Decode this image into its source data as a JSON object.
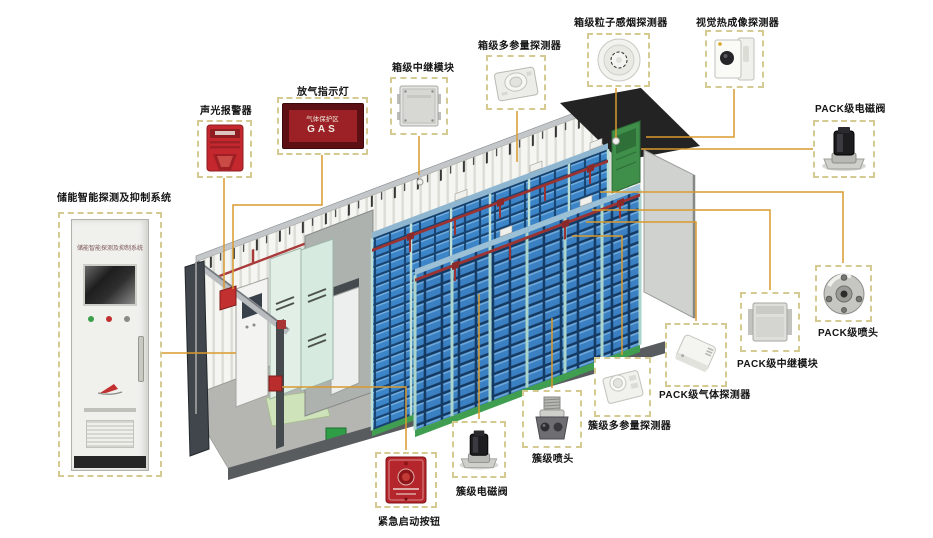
{
  "diagram": {
    "callouts": [
      {
        "id": "system-cabinet",
        "label": "储能智能探测及抑制系统"
      },
      {
        "id": "sound-light-alarm",
        "label": "声光报警器"
      },
      {
        "id": "gas-release-indicator",
        "label": "放气指示灯"
      },
      {
        "id": "box-relay-module",
        "label": "箱级中继模块"
      },
      {
        "id": "box-multi-param-detector",
        "label": "箱级多参量探测器"
      },
      {
        "id": "box-smoke-detector",
        "label": "箱级粒子感烟探测器"
      },
      {
        "id": "thermal-imaging-detector",
        "label": "视觉热成像探测器"
      },
      {
        "id": "pack-solenoid-valve",
        "label": "PACK级电磁阀"
      },
      {
        "id": "pack-nozzle",
        "label": "PACK级喷头"
      },
      {
        "id": "pack-relay-module",
        "label": "PACK级中继模块"
      },
      {
        "id": "pack-gas-detector",
        "label": "PACK级气体探测器"
      },
      {
        "id": "cluster-multi-param-detector",
        "label": "簇级多参量探测器"
      },
      {
        "id": "cluster-nozzle",
        "label": "簇级喷头"
      },
      {
        "id": "cluster-solenoid-valve",
        "label": "簇级电磁阀"
      },
      {
        "id": "emergency-start-button",
        "label": "紧急启动按钮"
      }
    ],
    "system_cabinet": {
      "panel_text": "储能智能探测及抑制系统"
    },
    "gas_indicator": {
      "zone_text": "气体保护区",
      "gas_text": "GAS"
    },
    "colors": {
      "connector": "#d99a2e",
      "callout_border": "#d5cb92",
      "battery_blue": "#3c85c8",
      "pipe_red": "#9c3333",
      "door_green": "#3f8f4a",
      "alarm_red": "#c4282e"
    }
  }
}
